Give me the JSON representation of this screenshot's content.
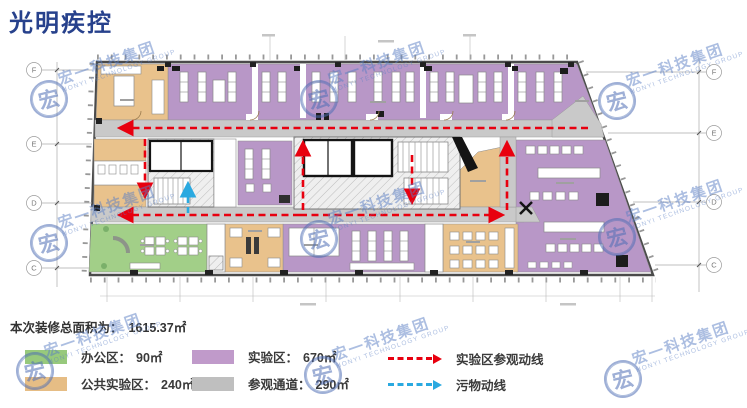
{
  "title": "光明疾控",
  "watermark": {
    "glyph": "宏",
    "line1": "宏一科技集团",
    "line2": "HONYI TECHNOLOGY GROUP"
  },
  "summary": {
    "label": "本次装修总面积为：",
    "value": "1615.37㎡"
  },
  "legend": {
    "zones": [
      {
        "key": "office",
        "label": "办公区：",
        "area": "90㎡",
        "color": "#97c97c"
      },
      {
        "key": "public-lab",
        "label": "公共实验区：",
        "area": "240㎡",
        "color": "#e6bd85"
      },
      {
        "key": "lab",
        "label": "实验区：",
        "area": "670㎡",
        "color": "#c09aca"
      },
      {
        "key": "corridor",
        "label": "参观通道：",
        "area": "290㎡",
        "color": "#bfbfbf"
      }
    ],
    "routes": [
      {
        "key": "lab-visit",
        "label": "实验区参观动线",
        "color": "#e8000f"
      },
      {
        "key": "waste",
        "label": "污物动线",
        "color": "#2aa9e0"
      }
    ]
  },
  "plan": {
    "grid_left": [
      "F",
      "E",
      "D",
      "C"
    ],
    "grid_right": [
      "F",
      "E",
      "D",
      "C"
    ]
  },
  "colors": {
    "zone_lab": "#b897c7",
    "zone_public_lab": "#e9c28c",
    "zone_office": "#a2cf88",
    "zone_corridor": "#c9c9c9",
    "route_visit": "#e8000f",
    "route_waste": "#2aa9e0",
    "title": "#27418c"
  }
}
